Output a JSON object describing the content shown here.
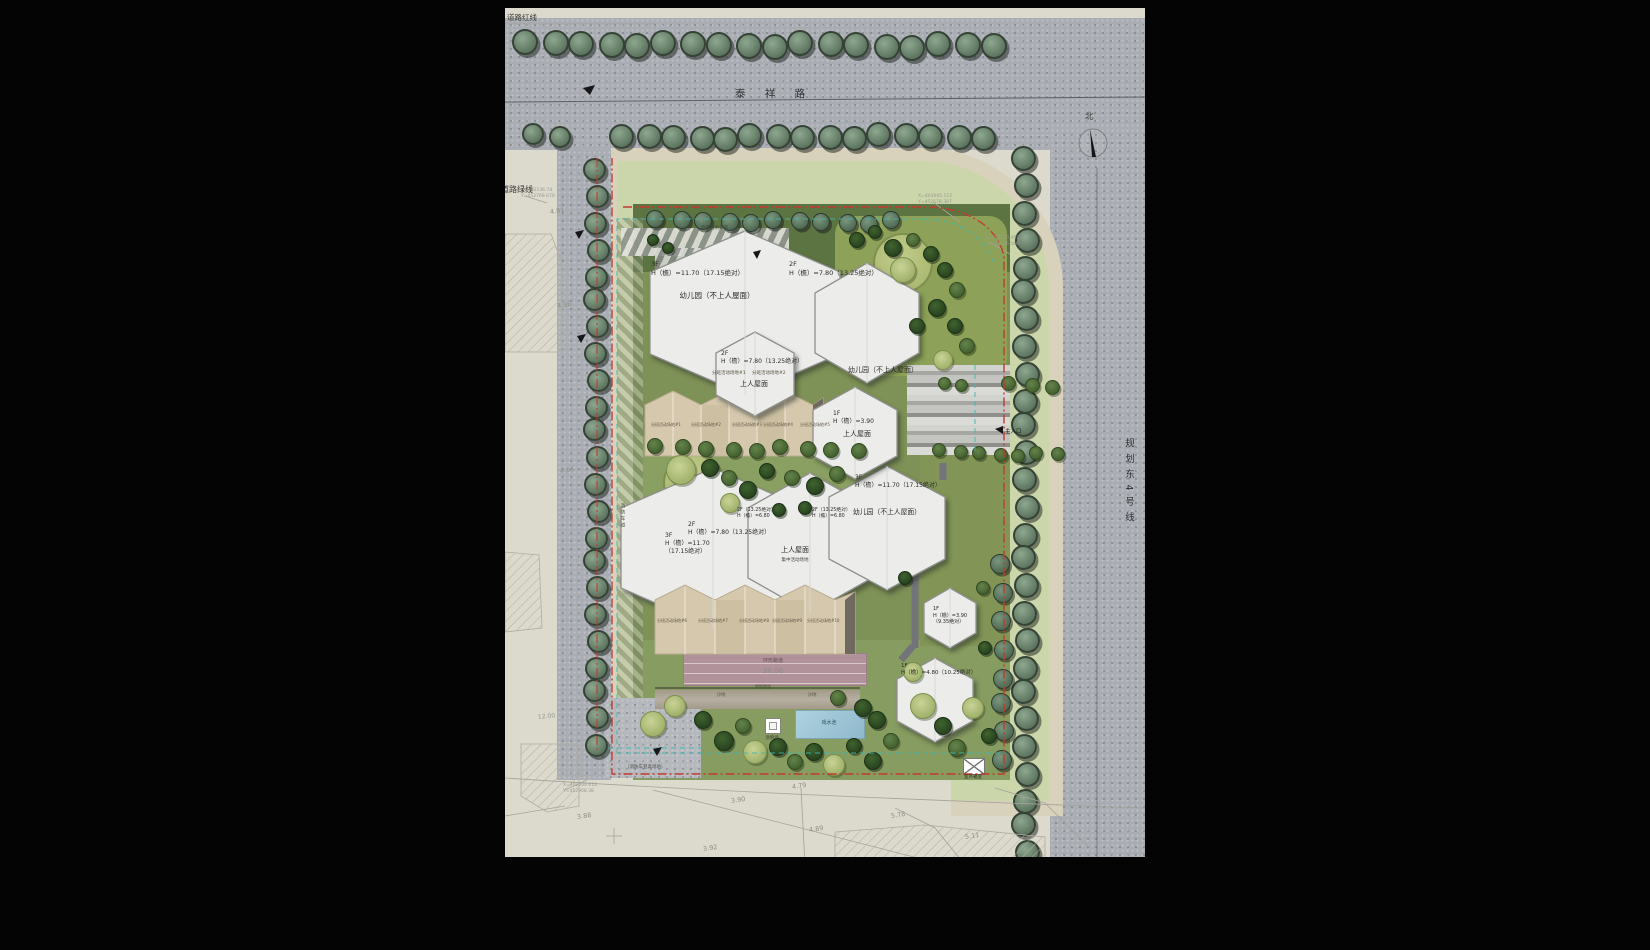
{
  "site_plan": {
    "roads": {
      "top_road": "泰 祥 路",
      "right_road": "规划东4号线",
      "red_line_label": "道路红线",
      "green_line_label": "道路绿线",
      "north_label": "北"
    },
    "colors": {
      "road": "#a9adb3",
      "lawn": "#ccd6ab",
      "site_green": "#7e9156",
      "building": "#ececea",
      "activity_strip": "#d6c8ad",
      "track": "#b2929a",
      "pool": "#9dc5d6",
      "boundary_red": "#c23b2e",
      "boundary_teal": "#3fb7ae"
    },
    "annotations": [
      {
        "x": 146,
        "y": 252,
        "t": "3F\nH（檐）=11.70（17.15绝对）",
        "s": 6.5
      },
      {
        "x": 212,
        "y": 283,
        "t": "幼儿园（不上人屋面）",
        "s": 7.5,
        "ctr": 1
      },
      {
        "x": 284,
        "y": 252,
        "t": "2F\nH（檐）=7.80（13.25绝对）",
        "s": 6.5
      },
      {
        "x": 378,
        "y": 358,
        "t": "幼儿园（不上人屋面）",
        "s": 7,
        "ctr": 1
      },
      {
        "x": 216,
        "y": 342,
        "t": "2F\nH（檐）=7.80（13.25绝对）",
        "s": 6
      },
      {
        "x": 207,
        "y": 363,
        "t": "分班活动场地#1",
        "s": 4.5,
        "c": "#55503f"
      },
      {
        "x": 247,
        "y": 363,
        "t": "分班活动场地#2",
        "s": 4.5,
        "c": "#55503f"
      },
      {
        "x": 249,
        "y": 372,
        "t": "上人屋面",
        "s": 7,
        "ctr": 1
      },
      {
        "x": 328,
        "y": 402,
        "t": "1F\nH（檐）=3.90",
        "s": 6
      },
      {
        "x": 352,
        "y": 422,
        "t": "上人屋面",
        "s": 7,
        "ctr": 1
      },
      {
        "x": 350,
        "y": 466,
        "t": "3F\nH（檐）=11.70（17.15绝对）",
        "s": 6
      },
      {
        "x": 232,
        "y": 500,
        "t": "2F（13.25绝对）\nH（檐）=6.80",
        "s": 4.8
      },
      {
        "x": 307,
        "y": 500,
        "t": "2F（13.25绝对）\nH（檐）=6.80",
        "s": 4.8
      },
      {
        "x": 183,
        "y": 513,
        "t": "2F\nH（檐）=7.80（13.25绝对）",
        "s": 6
      },
      {
        "x": 160,
        "y": 524,
        "t": "3F\nH（檐）=11.70\n（17.15绝对）",
        "s": 6
      },
      {
        "x": 290,
        "y": 538,
        "t": "上人屋面",
        "s": 7,
        "ctr": 1
      },
      {
        "x": 290,
        "y": 550,
        "t": "集中活动场地",
        "s": 4.5,
        "ctr": 1,
        "c": "#44443e"
      },
      {
        "x": 382,
        "y": 500,
        "t": "幼儿园（不上人屋面）",
        "s": 6.8,
        "ctr": 1
      },
      {
        "x": 428,
        "y": 598,
        "t": "1F\nH（檐）=3.90\n（9.35绝对）",
        "s": 5
      },
      {
        "x": 396,
        "y": 655,
        "t": "1F\nH（檐）=4.80（10.25绝对）",
        "s": 5.5
      },
      {
        "x": 146,
        "y": 414,
        "t": "分班活动场地#1",
        "s": 4,
        "c": "#5e5544"
      },
      {
        "x": 186,
        "y": 414,
        "t": "分班活动场地#2",
        "s": 4,
        "c": "#5e5544"
      },
      {
        "x": 227,
        "y": 414,
        "t": "分班活动场地#3",
        "s": 4,
        "c": "#5e5544"
      },
      {
        "x": 258,
        "y": 414,
        "t": "分班活动场地#4",
        "s": 4,
        "c": "#5e5544"
      },
      {
        "x": 295,
        "y": 414,
        "t": "分班活动场地#5",
        "s": 4,
        "c": "#5e5544"
      },
      {
        "x": 152,
        "y": 610,
        "t": "分班活动场地#6",
        "s": 4,
        "c": "#5e5544"
      },
      {
        "x": 193,
        "y": 610,
        "t": "分班活动场地#7",
        "s": 4,
        "c": "#5e5544"
      },
      {
        "x": 234,
        "y": 610,
        "t": "分班活动场地#8",
        "s": 4,
        "c": "#5e5544"
      },
      {
        "x": 267,
        "y": 610,
        "t": "分班活动场地#9",
        "s": 4,
        "c": "#5e5544"
      },
      {
        "x": 302,
        "y": 610,
        "t": "分班活动场地#10",
        "s": 4,
        "c": "#5e5544"
      },
      {
        "x": 268,
        "y": 650,
        "t": "环形跑道",
        "s": 5,
        "ctr": 1,
        "c": "#5f4f54"
      },
      {
        "x": 268,
        "y": 659,
        "t": "30.00",
        "s": 7,
        "ctr": 1,
        "c": "#8b8b83"
      },
      {
        "x": 250,
        "y": 676,
        "t": "塑胶跑道",
        "s": 4,
        "c": "#48543c"
      },
      {
        "x": 216,
        "y": 685,
        "t": "沙坑",
        "s": 4.5,
        "ctr": 1,
        "c": "#4f4b42"
      },
      {
        "x": 307,
        "y": 685,
        "t": "沙坑",
        "s": 4.5,
        "ctr": 1,
        "c": "#4f4b42"
      },
      {
        "x": 324,
        "y": 712,
        "t": "戏水池",
        "s": 5,
        "ctr": 1,
        "c": "#27525f"
      },
      {
        "x": 267,
        "y": 728,
        "t": "涂鸦墙",
        "s": 4.5,
        "ctr": 1,
        "c": "#3c3c38"
      },
      {
        "x": 468,
        "y": 767,
        "t": "室外箱变",
        "s": 4.5,
        "ctr": 1
      },
      {
        "x": 120,
        "y": 757,
        "t": "（消防车登高场地）",
        "s": 4.5,
        "c": "#50504a"
      },
      {
        "x": 33,
        "y": 705,
        "t": "12.00",
        "s": 6,
        "c": "#98988e",
        "r": -6
      },
      {
        "x": 500,
        "y": 421,
        "t": "主入口",
        "s": 5.5,
        "c": "#101010"
      },
      {
        "x": 196,
        "y": 218,
        "t": "隐形消防车道",
        "s": 4.5,
        "c": "#3f4a39"
      },
      {
        "x": 114,
        "y": 495,
        "t": "消防车道",
        "s": 4.5,
        "vert": 1,
        "c": "#3f3f3a"
      },
      {
        "x": 45,
        "y": 199,
        "t": "4.81",
        "s": 6.5,
        "c": "#8f8f85",
        "r": -8
      },
      {
        "x": 52,
        "y": 293,
        "t": "4.56",
        "s": 6.5,
        "c": "#8f8f85",
        "r": -8
      },
      {
        "x": 55,
        "y": 458,
        "t": "4.65",
        "s": 6.5,
        "c": "#8f8f85",
        "r": -8
      },
      {
        "x": 72,
        "y": 804,
        "t": "3.88",
        "s": 6.5,
        "c": "#8f8f85",
        "r": -8
      },
      {
        "x": 226,
        "y": 788,
        "t": "3.90",
        "s": 6.5,
        "c": "#8f8f85",
        "r": -8
      },
      {
        "x": 198,
        "y": 836,
        "t": "3.92",
        "s": 6.5,
        "c": "#8f8f85",
        "r": -8
      },
      {
        "x": 287,
        "y": 774,
        "t": "4.79",
        "s": 6.5,
        "c": "#8f8f85",
        "r": -8
      },
      {
        "x": 304,
        "y": 817,
        "t": "4.89",
        "s": 6.5,
        "c": "#8f8f85",
        "r": -8
      },
      {
        "x": 386,
        "y": 803,
        "t": "5.78",
        "s": 6.5,
        "c": "#8f8f85",
        "r": -8
      },
      {
        "x": 460,
        "y": 824,
        "t": "5.11",
        "s": 6.5,
        "c": "#8f8f85",
        "r": -8
      },
      {
        "x": 16,
        "y": 180,
        "t": "X=402136.74\nY=452769.670",
        "s": 4.5,
        "c": "#98988e"
      },
      {
        "x": 413,
        "y": 186,
        "t": "X=403045.112\nY=452578.387",
        "s": 4.5,
        "c": "#98988e"
      },
      {
        "x": 480,
        "y": 228,
        "t": "X=403133.451\nY=452786.566",
        "s": 4.5,
        "c": "#98988e"
      },
      {
        "x": 58,
        "y": 775,
        "t": "X=402200.012\nY=452908.38",
        "s": 4.5,
        "c": "#98988e"
      }
    ],
    "trees": {
      "rows": [
        [
          "s",
          22,
          36,
          490,
          38,
          18,
          13
        ],
        [
          "s",
          30,
          128,
          54,
          130,
          2,
          11
        ],
        [
          "s",
          118,
          130,
          478,
          128,
          15,
          12.5
        ],
        [
          "s",
          520,
          152,
          521,
          845,
          27,
          12.5
        ],
        [
          "s",
          91,
          163,
          92,
          737,
          23,
          11.5
        ],
        [
          "s2",
          152,
          213,
          388,
          214,
          11,
          9
        ],
        [
          "s2",
          497,
          558,
          498,
          752,
          8,
          10
        ],
        [
          "m",
          152,
          440,
          352,
          442,
          9,
          8
        ],
        [
          "m",
          441,
          377,
          455,
          378,
          2,
          6.5
        ],
        [
          "m",
          505,
          377,
          548,
          379,
          3,
          7.5
        ],
        [
          "m",
          436,
          444,
          552,
          447,
          7,
          7
        ]
      ],
      "singles": [
        [
          "d",
          352,
          232,
          8
        ],
        [
          "d",
          370,
          224,
          7
        ],
        [
          "d",
          388,
          240,
          9
        ],
        [
          "m",
          408,
          232,
          7
        ],
        [
          "d",
          426,
          246,
          8
        ],
        [
          "l",
          398,
          262,
          13
        ],
        [
          "d",
          440,
          262,
          8
        ],
        [
          "m",
          452,
          282,
          8
        ],
        [
          "d",
          432,
          300,
          9
        ],
        [
          "d",
          450,
          318,
          8
        ],
        [
          "m",
          462,
          338,
          8
        ],
        [
          "d",
          412,
          318,
          8
        ],
        [
          "l",
          438,
          352,
          10
        ],
        [
          "d",
          148,
          232,
          6
        ],
        [
          "d",
          163,
          240,
          6
        ],
        [
          "l",
          176,
          462,
          15
        ],
        [
          "d",
          205,
          460,
          9
        ],
        [
          "m",
          224,
          470,
          8
        ],
        [
          "d",
          243,
          482,
          9
        ],
        [
          "d",
          262,
          463,
          8
        ],
        [
          "m",
          287,
          470,
          8
        ],
        [
          "d",
          310,
          478,
          9
        ],
        [
          "m",
          332,
          466,
          8
        ],
        [
          "d",
          300,
          500,
          7
        ],
        [
          "d",
          274,
          502,
          7
        ],
        [
          "l",
          225,
          495,
          10
        ],
        [
          "d",
          400,
          570,
          7
        ],
        [
          "m",
          478,
          580,
          7
        ],
        [
          "d",
          480,
          640,
          7
        ],
        [
          "l",
          408,
          664,
          10
        ],
        [
          "l",
          148,
          716,
          13
        ],
        [
          "l",
          170,
          698,
          11
        ],
        [
          "d",
          198,
          712,
          9
        ],
        [
          "d",
          219,
          733,
          10
        ],
        [
          "m",
          238,
          718,
          8
        ],
        [
          "l",
          250,
          744,
          12
        ],
        [
          "d",
          273,
          739,
          9
        ],
        [
          "m",
          290,
          754,
          8
        ],
        [
          "d",
          309,
          744,
          9
        ],
        [
          "l",
          329,
          757,
          11
        ],
        [
          "d",
          349,
          738,
          8
        ],
        [
          "d",
          368,
          753,
          9
        ],
        [
          "m",
          386,
          733,
          8
        ],
        [
          "l",
          418,
          698,
          13
        ],
        [
          "d",
          438,
          718,
          9
        ],
        [
          "m",
          452,
          740,
          9
        ],
        [
          "l",
          468,
          700,
          11
        ],
        [
          "d",
          484,
          728,
          8
        ],
        [
          "d",
          358,
          700,
          9
        ],
        [
          "m",
          333,
          690,
          8
        ],
        [
          "d",
          372,
          712,
          9
        ]
      ]
    }
  }
}
